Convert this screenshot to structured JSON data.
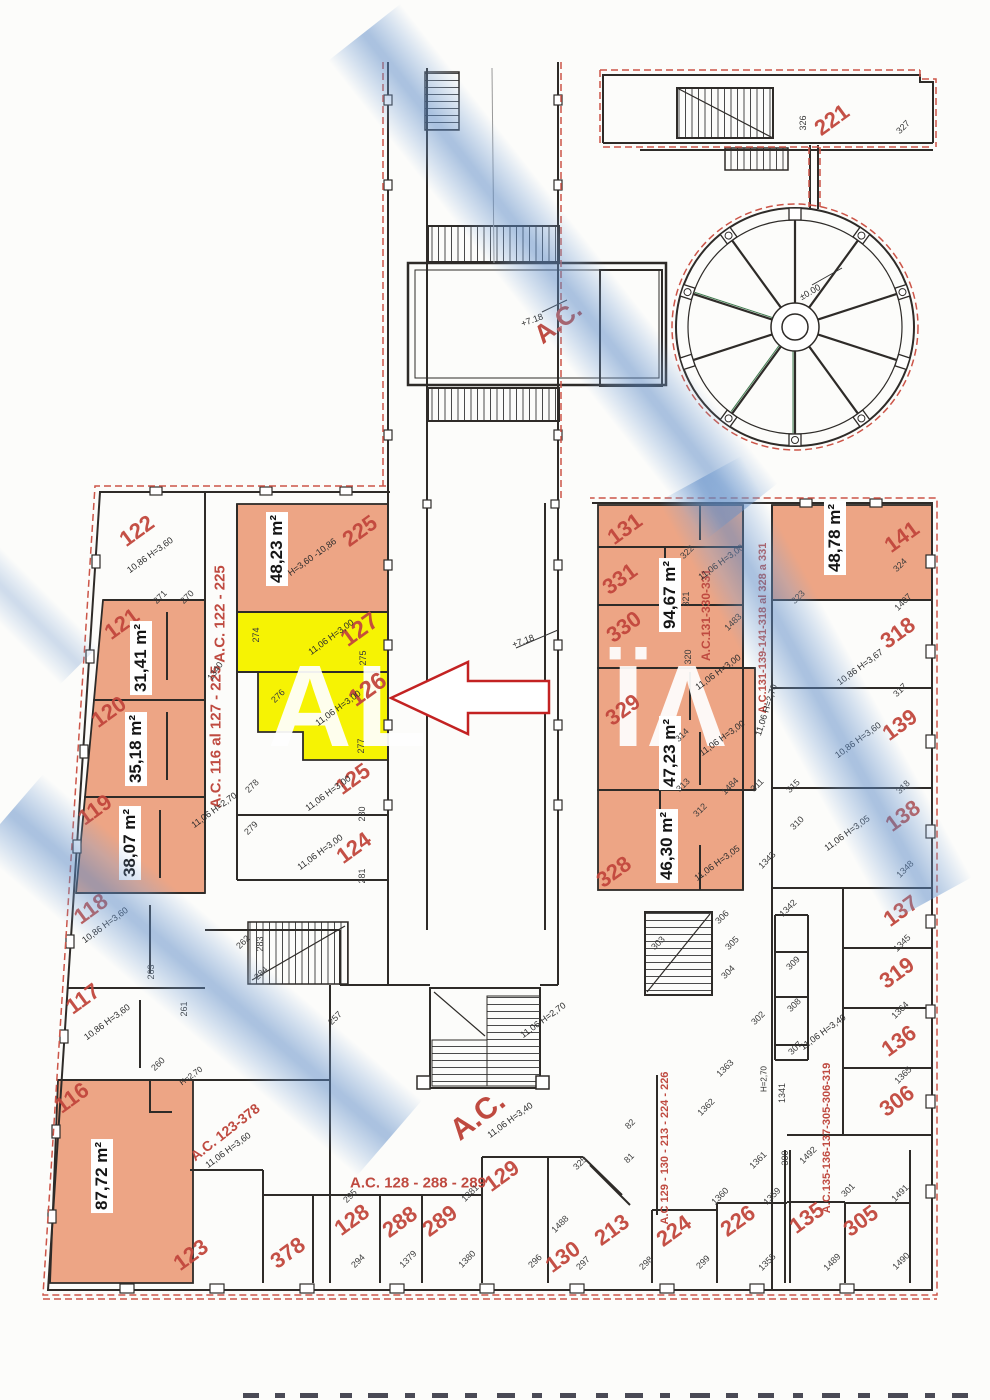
{
  "watermark": {
    "left_fragment": "AL",
    "right_fragment": "ÏΛ"
  },
  "colors": {
    "salmon_fill": "#eda585",
    "yellow_highlight": "#f6f303",
    "label_red": "#c2473d",
    "boundary_dashed_red": "#cc5548",
    "wall": "#2e2b28",
    "watercolor_blue": "#a9c9e6",
    "arrow_red": "#c32222"
  },
  "unit_labels": [
    {
      "t": "122",
      "x": 137,
      "y": 531,
      "r": -36
    },
    {
      "t": "225",
      "x": 360,
      "y": 531,
      "r": -36
    },
    {
      "t": "121",
      "x": 122,
      "y": 624,
      "r": -36
    },
    {
      "t": "127",
      "x": 360,
      "y": 630,
      "r": -36,
      "s": 24
    },
    {
      "t": "120",
      "x": 109,
      "y": 712,
      "r": -36
    },
    {
      "t": "126",
      "x": 368,
      "y": 690,
      "r": -36,
      "s": 24
    },
    {
      "t": "119",
      "x": 95,
      "y": 810,
      "r": -36
    },
    {
      "t": "125",
      "x": 353,
      "y": 779,
      "r": -36
    },
    {
      "t": "124",
      "x": 354,
      "y": 848,
      "r": -36
    },
    {
      "t": "118",
      "x": 91,
      "y": 909,
      "r": -36
    },
    {
      "t": "117",
      "x": 83,
      "y": 999,
      "r": -36
    },
    {
      "t": "116",
      "x": 72,
      "y": 1098,
      "r": -36
    },
    {
      "t": "123",
      "x": 191,
      "y": 1255,
      "r": -36
    },
    {
      "t": "378",
      "x": 288,
      "y": 1253,
      "r": -36
    },
    {
      "t": "128",
      "x": 352,
      "y": 1220,
      "r": -36
    },
    {
      "t": "288",
      "x": 400,
      "y": 1222,
      "r": -36
    },
    {
      "t": "289",
      "x": 440,
      "y": 1221,
      "r": -36
    },
    {
      "t": "129",
      "x": 502,
      "y": 1176,
      "r": -36
    },
    {
      "t": "130",
      "x": 563,
      "y": 1257,
      "r": -36
    },
    {
      "t": "213",
      "x": 612,
      "y": 1230,
      "r": -36
    },
    {
      "t": "224",
      "x": 674,
      "y": 1231,
      "r": -36
    },
    {
      "t": "226",
      "x": 738,
      "y": 1221,
      "r": -36
    },
    {
      "t": "135",
      "x": 807,
      "y": 1218,
      "r": -36
    },
    {
      "t": "305",
      "x": 861,
      "y": 1221,
      "r": -36
    },
    {
      "t": "306",
      "x": 897,
      "y": 1101,
      "r": -36
    },
    {
      "t": "136",
      "x": 899,
      "y": 1041,
      "r": -36
    },
    {
      "t": "319",
      "x": 897,
      "y": 973,
      "r": -36
    },
    {
      "t": "137",
      "x": 901,
      "y": 911,
      "r": -36
    },
    {
      "t": "138",
      "x": 903,
      "y": 816,
      "r": -36
    },
    {
      "t": "139",
      "x": 900,
      "y": 725,
      "r": -36
    },
    {
      "t": "318",
      "x": 898,
      "y": 633,
      "r": -36
    },
    {
      "t": "141",
      "x": 902,
      "y": 537,
      "r": -36
    },
    {
      "t": "131",
      "x": 625,
      "y": 529,
      "r": -36
    },
    {
      "t": "331",
      "x": 620,
      "y": 579,
      "r": -36
    },
    {
      "t": "330",
      "x": 624,
      "y": 627,
      "r": -36
    },
    {
      "t": "329",
      "x": 623,
      "y": 710,
      "r": -36
    },
    {
      "t": "328",
      "x": 614,
      "y": 872,
      "r": -36
    },
    {
      "t": "221",
      "x": 832,
      "y": 120,
      "r": -36
    }
  ],
  "area_labels": [
    {
      "t": "48,23 m²",
      "x": 277,
      "y": 549,
      "r": -90
    },
    {
      "t": "31,41 m²",
      "x": 141,
      "y": 658,
      "r": -90
    },
    {
      "t": "35,18 m²",
      "x": 136,
      "y": 749,
      "r": -90
    },
    {
      "t": "38,07 m²",
      "x": 130,
      "y": 843,
      "r": -90
    },
    {
      "t": "87,72 m²",
      "x": 102,
      "y": 1176,
      "r": -90
    },
    {
      "t": "94,67 m²",
      "x": 670,
      "y": 595,
      "r": -90
    },
    {
      "t": "47,23 m²",
      "x": 670,
      "y": 753,
      "r": -90
    },
    {
      "t": "46,30 m²",
      "x": 667,
      "y": 846,
      "r": -90
    },
    {
      "t": "48,78 m²",
      "x": 835,
      "y": 538,
      "r": -90
    }
  ],
  "ac_labels": [
    {
      "t": "A.C. 122 - 225",
      "x": 220,
      "y": 614,
      "r": -90,
      "s": 15
    },
    {
      "t": "A.C. 116 al 127 - 225",
      "x": 216,
      "y": 737,
      "r": -90,
      "s": 15
    },
    {
      "t": "A.C.131-330-331",
      "x": 706,
      "y": 615,
      "r": -90,
      "s": 12
    },
    {
      "t": "A.C.131-139-141-318 al 328 a 331",
      "x": 763,
      "y": 628,
      "r": -90,
      "s": 11
    },
    {
      "t": "A.C. 123-378",
      "x": 225,
      "y": 1132,
      "r": -38,
      "s": 14
    },
    {
      "t": "A.C. 128 - 288 - 289",
      "x": 418,
      "y": 1183,
      "r": 0,
      "s": 15
    },
    {
      "t": "A.C 129 - 130 - 213 - 224 - 226",
      "x": 665,
      "y": 1148,
      "r": -90,
      "s": 11
    },
    {
      "t": "A.C.135-136-137-305-306-319",
      "x": 827,
      "y": 1138,
      "r": -90,
      "s": 11
    },
    {
      "t": "A.C.",
      "x": 478,
      "y": 1116,
      "r": -38,
      "s": 30
    },
    {
      "t": "A.C.",
      "x": 558,
      "y": 322,
      "r": -38,
      "s": 26
    }
  ],
  "dim_labels": [
    {
      "t": "10,86 H=3,60",
      "x": 150,
      "y": 555,
      "r": -36
    },
    {
      "t": "H=3,60 -10,86",
      "x": 312,
      "y": 557,
      "r": -36
    },
    {
      "t": "11,06 H=3,00",
      "x": 331,
      "y": 637,
      "r": -36
    },
    {
      "t": "11,06 H=3,00",
      "x": 338,
      "y": 708,
      "r": -36
    },
    {
      "t": "11,06 H=3,00",
      "x": 328,
      "y": 793,
      "r": -36
    },
    {
      "t": "11,06 H=3,00",
      "x": 320,
      "y": 852,
      "r": -36
    },
    {
      "t": "11,06 H=2,70",
      "x": 214,
      "y": 810,
      "r": -36
    },
    {
      "t": "10,86 H=3,60",
      "x": 105,
      "y": 925,
      "r": -36
    },
    {
      "t": "10,86 H=3,60",
      "x": 107,
      "y": 1022,
      "r": -36
    },
    {
      "t": "11,06 H=3,60",
      "x": 228,
      "y": 1150,
      "r": -36
    },
    {
      "t": "11,06 H=2,70",
      "x": 543,
      "y": 1020,
      "r": -36
    },
    {
      "t": "11,06 H=3,40",
      "x": 510,
      "y": 1120,
      "r": -36
    },
    {
      "t": "11,06 H=2,70",
      "x": 766,
      "y": 710,
      "r": -72
    },
    {
      "t": "10,86 H=3,67",
      "x": 860,
      "y": 667,
      "r": -36
    },
    {
      "t": "10,86 H=3,60",
      "x": 858,
      "y": 740,
      "r": -36
    },
    {
      "t": "11,06 H=3,05",
      "x": 847,
      "y": 833,
      "r": -36
    },
    {
      "t": "11,06 H=3,40",
      "x": 823,
      "y": 1032,
      "r": -36
    },
    {
      "t": "11,06 H=3,00",
      "x": 721,
      "y": 562,
      "r": -36
    },
    {
      "t": "11,06 H=3,00",
      "x": 718,
      "y": 672,
      "r": -36
    },
    {
      "t": "11,06 H=3,00",
      "x": 722,
      "y": 738,
      "r": -36
    },
    {
      "t": "11,06 H=3,05",
      "x": 717,
      "y": 863,
      "r": -36
    },
    {
      "t": "+7.18",
      "x": 532,
      "y": 320,
      "r": -20
    },
    {
      "t": "+7.18",
      "x": 523,
      "y": 641,
      "r": -20
    },
    {
      "t": "±0.00",
      "x": 810,
      "y": 292,
      "r": -30
    },
    {
      "t": "H=2,70",
      "x": 191,
      "y": 1076,
      "r": -36,
      "s": 8
    },
    {
      "t": "H=2,70",
      "x": 764,
      "y": 1079,
      "r": -90,
      "s": 8
    }
  ],
  "room_numbers": [
    {
      "t": "271",
      "x": 160,
      "y": 597,
      "r": -45
    },
    {
      "t": "270",
      "x": 187,
      "y": 597,
      "r": -45
    },
    {
      "t": "274",
      "x": 256,
      "y": 635,
      "r": -90
    },
    {
      "t": "275",
      "x": 363,
      "y": 658,
      "r": -90
    },
    {
      "t": "276",
      "x": 278,
      "y": 696,
      "r": -45
    },
    {
      "t": "277",
      "x": 361,
      "y": 746,
      "r": -90
    },
    {
      "t": "278",
      "x": 252,
      "y": 786,
      "r": -45
    },
    {
      "t": "279",
      "x": 251,
      "y": 828,
      "r": -45
    },
    {
      "t": "280",
      "x": 362,
      "y": 814,
      "r": -90
    },
    {
      "t": "281",
      "x": 362,
      "y": 876,
      "r": -90
    },
    {
      "t": "262",
      "x": 243,
      "y": 942,
      "r": -45
    },
    {
      "t": "283",
      "x": 260,
      "y": 944,
      "r": -90
    },
    {
      "t": "284",
      "x": 261,
      "y": 973,
      "r": -45
    },
    {
      "t": "263",
      "x": 151,
      "y": 972,
      "r": -90
    },
    {
      "t": "261",
      "x": 184,
      "y": 1009,
      "r": -90
    },
    {
      "t": "260",
      "x": 158,
      "y": 1064,
      "r": -45
    },
    {
      "t": "257",
      "x": 335,
      "y": 1018,
      "r": -45
    },
    {
      "t": "295",
      "x": 350,
      "y": 1196,
      "r": -45
    },
    {
      "t": "294",
      "x": 358,
      "y": 1261,
      "r": -45
    },
    {
      "t": "1379",
      "x": 408,
      "y": 1259,
      "r": -45
    },
    {
      "t": "1380",
      "x": 467,
      "y": 1259,
      "r": -45
    },
    {
      "t": "1381",
      "x": 470,
      "y": 1193,
      "r": -45
    },
    {
      "t": "296",
      "x": 535,
      "y": 1261,
      "r": -45
    },
    {
      "t": "1488",
      "x": 560,
      "y": 1224,
      "r": -45
    },
    {
      "t": "297",
      "x": 583,
      "y": 1263,
      "r": -45
    },
    {
      "t": "298",
      "x": 646,
      "y": 1263,
      "r": -45
    },
    {
      "t": "325",
      "x": 580,
      "y": 1163,
      "r": -45
    },
    {
      "t": "82",
      "x": 630,
      "y": 1124,
      "r": -45
    },
    {
      "t": "81",
      "x": 629,
      "y": 1158,
      "r": -45
    },
    {
      "t": "1362",
      "x": 706,
      "y": 1107,
      "r": -45
    },
    {
      "t": "1341",
      "x": 782,
      "y": 1093,
      "r": -90
    },
    {
      "t": "1361",
      "x": 758,
      "y": 1160,
      "r": -45
    },
    {
      "t": "300",
      "x": 785,
      "y": 1158,
      "r": -90
    },
    {
      "t": "1492",
      "x": 808,
      "y": 1155,
      "r": -45
    },
    {
      "t": "1360",
      "x": 720,
      "y": 1196,
      "r": -45
    },
    {
      "t": "1359",
      "x": 772,
      "y": 1196,
      "r": -45
    },
    {
      "t": "299",
      "x": 703,
      "y": 1262,
      "r": -45
    },
    {
      "t": "1358",
      "x": 767,
      "y": 1262,
      "r": -45
    },
    {
      "t": "301",
      "x": 848,
      "y": 1190,
      "r": -45
    },
    {
      "t": "1489",
      "x": 832,
      "y": 1262,
      "r": -45
    },
    {
      "t": "1490",
      "x": 901,
      "y": 1261,
      "r": -45
    },
    {
      "t": "1491",
      "x": 900,
      "y": 1193,
      "r": -45
    },
    {
      "t": "302",
      "x": 758,
      "y": 1018,
      "r": -45
    },
    {
      "t": "307",
      "x": 795,
      "y": 1048,
      "r": -45
    },
    {
      "t": "308",
      "x": 794,
      "y": 1005,
      "r": -45
    },
    {
      "t": "309",
      "x": 793,
      "y": 963,
      "r": -45
    },
    {
      "t": "1342",
      "x": 788,
      "y": 908,
      "r": -45
    },
    {
      "t": "1343",
      "x": 767,
      "y": 860,
      "r": -45
    },
    {
      "t": "310",
      "x": 797,
      "y": 823,
      "r": -45
    },
    {
      "t": "306",
      "x": 722,
      "y": 917,
      "r": -45
    },
    {
      "t": "305",
      "x": 732,
      "y": 943,
      "r": -45
    },
    {
      "t": "304",
      "x": 728,
      "y": 972,
      "r": -45
    },
    {
      "t": "303",
      "x": 658,
      "y": 943,
      "r": -45
    },
    {
      "t": "312",
      "x": 700,
      "y": 810,
      "r": -45
    },
    {
      "t": "311",
      "x": 757,
      "y": 785,
      "r": -45
    },
    {
      "t": "313",
      "x": 683,
      "y": 785,
      "r": -45
    },
    {
      "t": "1484",
      "x": 730,
      "y": 786,
      "r": -45
    },
    {
      "t": "314",
      "x": 682,
      "y": 735,
      "r": -45
    },
    {
      "t": "315",
      "x": 793,
      "y": 786,
      "r": -45
    },
    {
      "t": "320",
      "x": 688,
      "y": 657,
      "r": -90
    },
    {
      "t": "321",
      "x": 686,
      "y": 599,
      "r": -90
    },
    {
      "t": "322",
      "x": 687,
      "y": 552,
      "r": -45
    },
    {
      "t": "1483",
      "x": 733,
      "y": 622,
      "r": -45
    },
    {
      "t": "323",
      "x": 798,
      "y": 597,
      "r": -45
    },
    {
      "t": "324",
      "x": 900,
      "y": 565,
      "r": -45
    },
    {
      "t": "1407",
      "x": 903,
      "y": 602,
      "r": -45
    },
    {
      "t": "317",
      "x": 900,
      "y": 690,
      "r": -45
    },
    {
      "t": "318",
      "x": 903,
      "y": 787,
      "r": -45
    },
    {
      "t": "1348",
      "x": 905,
      "y": 869,
      "r": -45
    },
    {
      "t": "1345",
      "x": 902,
      "y": 943,
      "r": -45
    },
    {
      "t": "1364",
      "x": 900,
      "y": 1010,
      "r": -45
    },
    {
      "t": "1365",
      "x": 903,
      "y": 1075,
      "r": -45
    },
    {
      "t": "326",
      "x": 803,
      "y": 123,
      "r": -90
    },
    {
      "t": "327",
      "x": 903,
      "y": 127,
      "r": -45
    },
    {
      "t": "1340",
      "x": 215,
      "y": 671,
      "r": -55
    },
    {
      "t": "1363",
      "x": 725,
      "y": 1068,
      "r": -45
    }
  ]
}
